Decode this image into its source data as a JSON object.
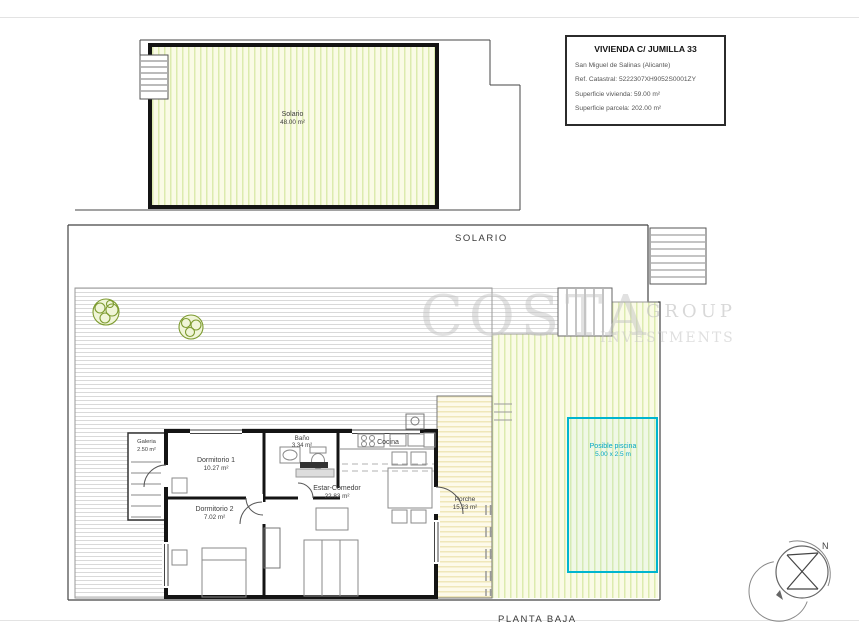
{
  "title_block": {
    "title": "VIVIENDA C/ JUMILLA 33",
    "location": "San Miguel de Salinas (Alicante)",
    "ref_catastral": "Ref. Catastral: 5222307XH9052S0001ZY",
    "superficie_vivienda": "Superficie vivienda: 59.00 m²",
    "superficie_parcela": "Superficie parcela: 202.00 m²"
  },
  "roof_plan": {
    "solario": {
      "name": "Solario",
      "area": "48.00 m²"
    }
  },
  "floor_plan": {
    "section_label_solario": "SOLARIO",
    "section_label_planta": "PLANTA BAJA",
    "rooms": {
      "dormitorio1": {
        "name": "Dormitorio 1",
        "area": "10.27 m²"
      },
      "bano": {
        "name": "Baño",
        "area": "3.34 m²"
      },
      "cocina": {
        "name": "Cocina"
      },
      "estar_comedor": {
        "name": "Estar-Comedor",
        "area": "22.83 m²"
      },
      "dormitorio2": {
        "name": "Dormitorio 2",
        "area": "7.02 m²"
      },
      "galeria": {
        "name": "Galeria",
        "area": "2.50 m²"
      },
      "porche": {
        "name": "Porche",
        "area": "15.23 m²"
      }
    },
    "pool": {
      "name": "Posible piscina",
      "dimensions": "5.00 x 2.5 m"
    }
  },
  "watermark": {
    "line1": "COSTA",
    "line2": "GROUP",
    "line3": "INVESTMENTS"
  },
  "compass": {
    "north_label": "N"
  },
  "colors": {
    "pool_accent": "#00b5cf",
    "wall": "#1a1a1a",
    "terrace_hatch": "#d9d9d9",
    "garden_hatch": "#dcebae",
    "porch_hatch": "#efe7b9",
    "tree": "#7d9b30",
    "watermark": "#c4c4c4"
  }
}
